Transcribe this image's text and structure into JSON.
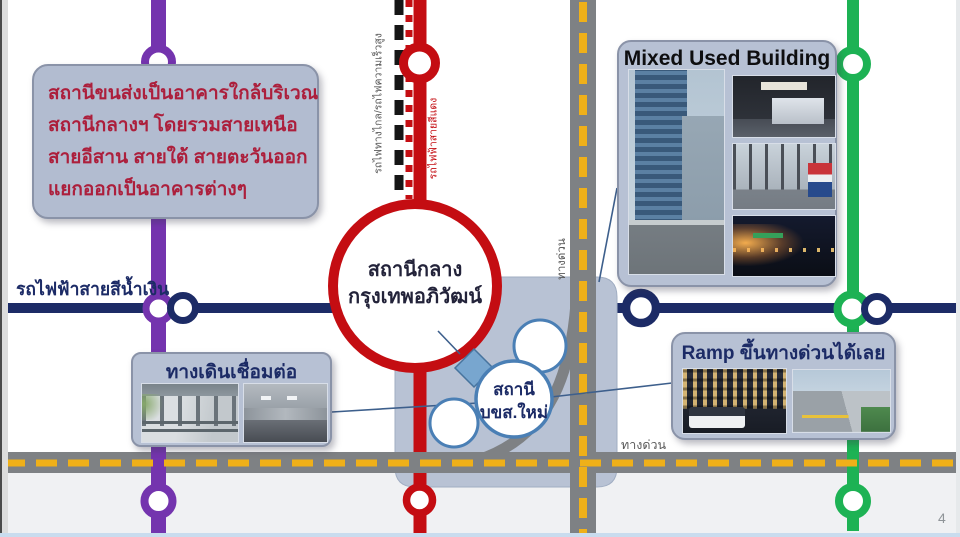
{
  "page": {
    "number": "4"
  },
  "annotation": {
    "lines": [
      "สถานีขนส่งเป็นอาคารใกล้บริเวณ",
      "สถานีกลางฯ โดยรวมสายเหนือ",
      "สายอีสาน สายใต้ สายตะวันออก",
      "แยกออกเป็นอาคารต่างๆ"
    ]
  },
  "labels": {
    "blue_line": "รถไฟฟ้าสายสีน้ำเงิน",
    "intercity_rail": "รถไฟทางไกล/รถไฟความเร็วสูง",
    "red_line": "รถไฟฟ้าสายสีแดง",
    "expressway_vertical": "ทางด่วน",
    "expressway_horizontal": "ทางด่วน"
  },
  "stations": {
    "central": {
      "line1": "สถานีกลาง",
      "line2": "กรุงเทพอภิวัฒน์"
    },
    "bus_terminal": {
      "line1": "สถานี",
      "line2": "บขส.ใหม่"
    }
  },
  "callouts": {
    "mixed_use": {
      "title": "Mixed Used Building",
      "photos": [
        "city skyscraper street view",
        "bus terminal hall counter",
        "glass entrance with bus livery",
        "night street market"
      ]
    },
    "walkway": {
      "title": "ทางเดินเชื่อมต่อ",
      "photos": [
        "covered elevated skywalk",
        "underground corridor"
      ]
    },
    "ramp": {
      "title": "Ramp ขึ้นทางด่วนได้เลย",
      "photos": [
        "bus leaving terminal at night",
        "elevated expressway ramp"
      ]
    }
  },
  "colors": {
    "purple_line": "#7434ae",
    "red_line": "#c40d12",
    "green_line": "#1db254",
    "navy_blue_line": "#1c2b66",
    "road_gray": "#7e8184",
    "road_dash_yellow": "#efb019",
    "station_area_fill": "#b8c2d4",
    "callout_fill": "#b7c1d4",
    "annotation_text": "#ac1f3c"
  }
}
